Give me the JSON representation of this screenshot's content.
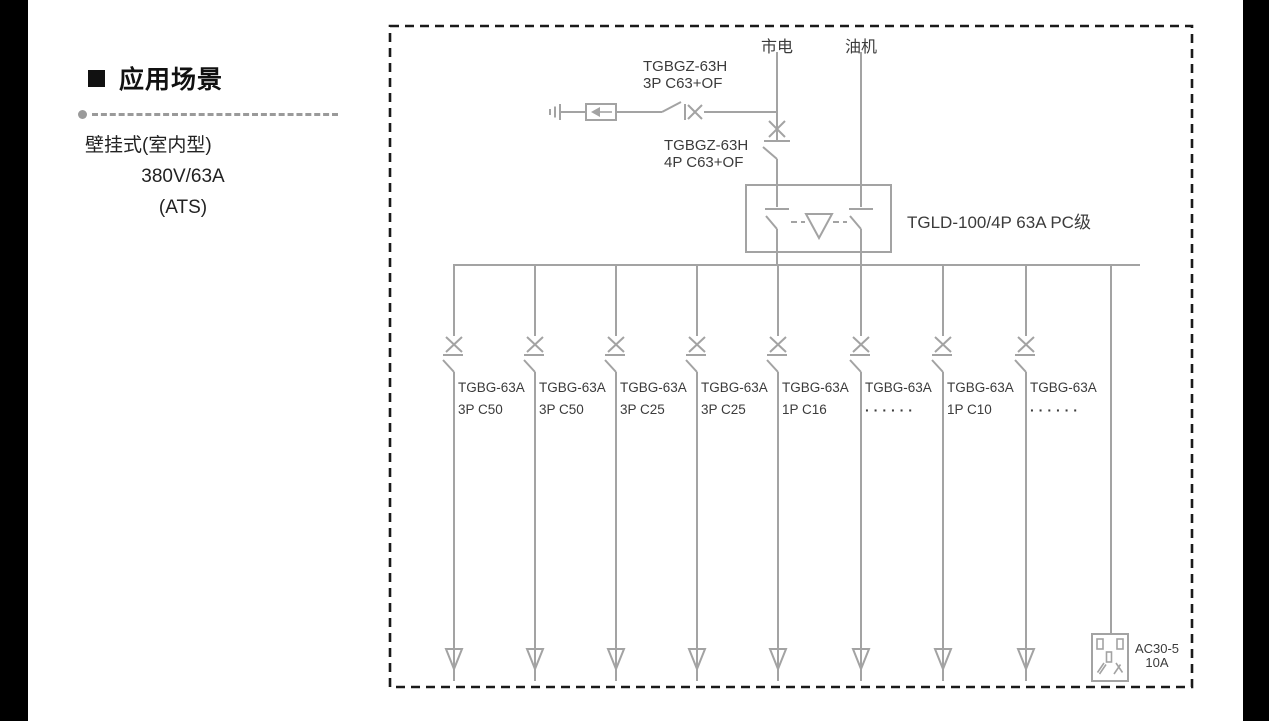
{
  "sidebar": {
    "title": "应用场景",
    "lines": [
      "壁挂式(室内型)",
      "380V/63A",
      "(ATS)"
    ]
  },
  "diagram": {
    "sources": {
      "mains": "市电",
      "generator": "油机"
    },
    "spd_breaker": {
      "line1": "TGBGZ-63H",
      "line2": "3P C63+OF"
    },
    "main_breaker": {
      "line1": "TGBGZ-63H",
      "line2": "4P C63+OF"
    },
    "ats": {
      "label": "TGLD-100/4P 63A PC级"
    },
    "branches": [
      {
        "model": "TGBG-63A",
        "spec": "3P C50"
      },
      {
        "model": "TGBG-63A",
        "spec": "3P C50"
      },
      {
        "model": "TGBG-63A",
        "spec": "3P C25"
      },
      {
        "model": "TGBG-63A",
        "spec": "3P C25"
      },
      {
        "model": "TGBG-63A",
        "spec": "1P C16"
      },
      {
        "model": "TGBG-63A",
        "spec": "······"
      },
      {
        "model": "TGBG-63A",
        "spec": "1P C10"
      },
      {
        "model": "TGBG-63A",
        "spec": "······"
      }
    ],
    "socket": {
      "line1": "AC30-5",
      "line2": "10A"
    }
  },
  "colors": {
    "diagram_line": "#a3a3a3",
    "diagram_text": "#3b3b3b",
    "border": "#1a1a1a",
    "sidebar_text": "#111111"
  }
}
